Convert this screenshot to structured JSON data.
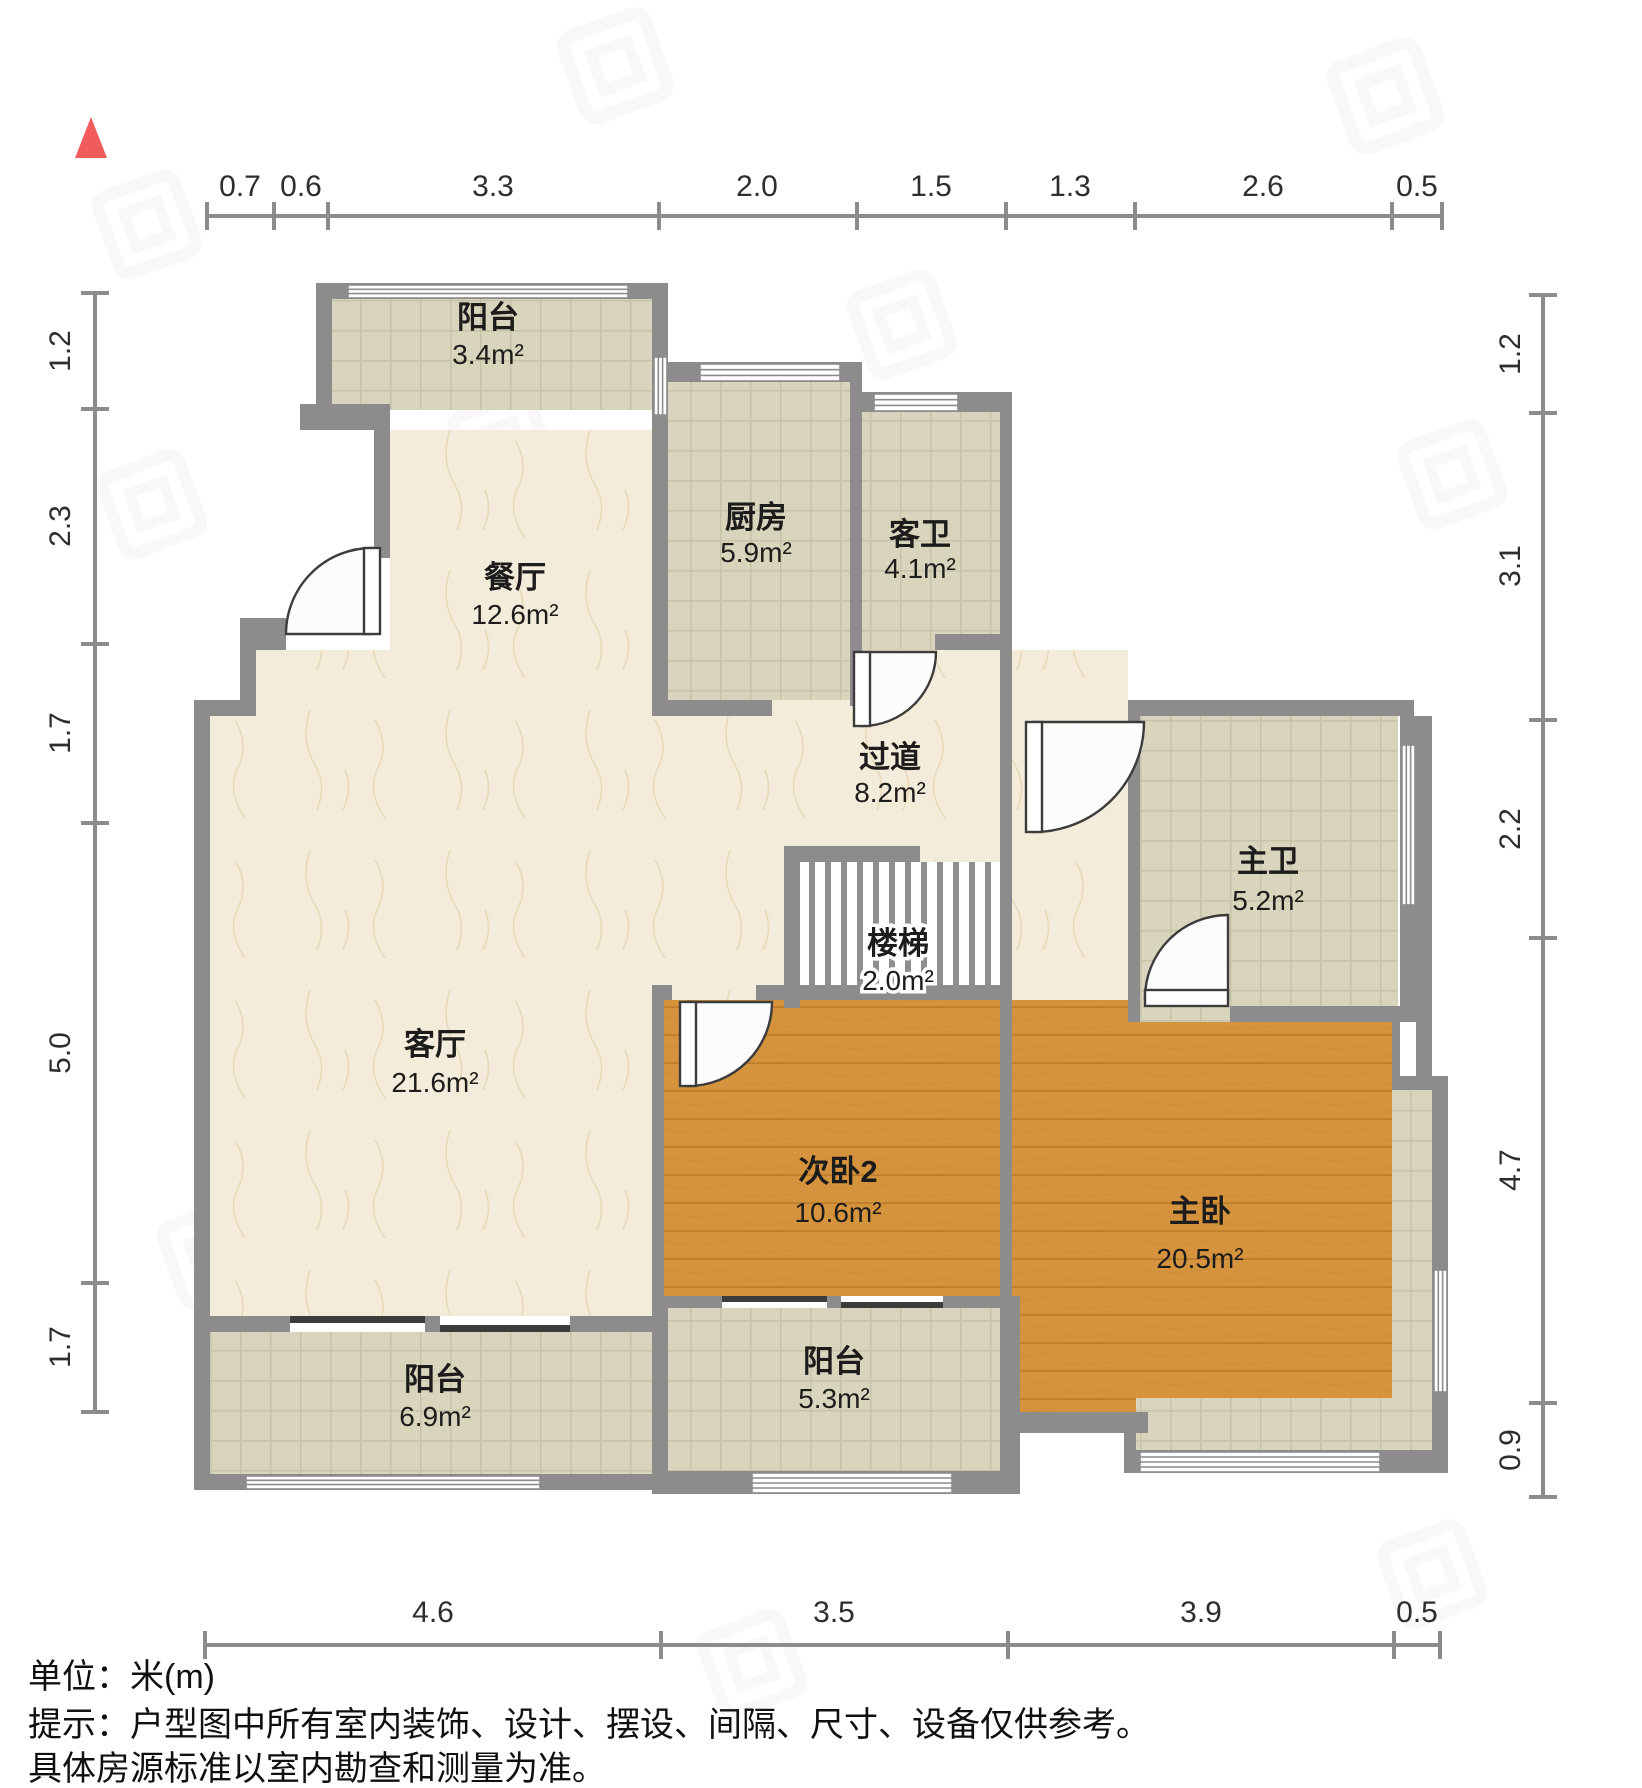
{
  "rooms": {
    "balcony_top": {
      "name": "阳台",
      "area": "3.4m²"
    },
    "dining": {
      "name": "餐厅",
      "area": "12.6m²"
    },
    "kitchen": {
      "name": "厨房",
      "area": "5.9m²"
    },
    "guest_bath": {
      "name": "客卫",
      "area": "4.1m²"
    },
    "hallway": {
      "name": "过道",
      "area": "8.2m²"
    },
    "stairs": {
      "name": "楼梯",
      "area": "2.0m²"
    },
    "master_bath": {
      "name": "主卫",
      "area": "5.2m²"
    },
    "living": {
      "name": "客厅",
      "area": "21.6m²"
    },
    "bed2": {
      "name": "次卧2",
      "area": "10.6m²"
    },
    "master_bed": {
      "name": "主卧",
      "area": "20.5m²"
    },
    "balcony_left": {
      "name": "阳台",
      "area": "6.9m²"
    },
    "balcony_mid": {
      "name": "阳台",
      "area": "5.3m²"
    }
  },
  "dims": {
    "top": [
      "0.7",
      "0.6",
      "3.3",
      "2.0",
      "1.5",
      "1.3",
      "2.6",
      "0.5"
    ],
    "left": [
      "1.2",
      "2.3",
      "1.7",
      "5.0",
      "1.7"
    ],
    "right": [
      "1.2",
      "3.1",
      "2.2",
      "4.7",
      "0.9"
    ],
    "bottom": [
      "4.6",
      "3.5",
      "3.9",
      "0.5"
    ]
  },
  "footer": {
    "unit": "单位：米(m)",
    "tip1": "提示：户型图中所有室内装饰、设计、摆设、间隔、尺寸、设备仅供参考。",
    "tip2": "具体房源标准以室内勘查和测量为准。"
  },
  "colors": {
    "wall": "#8c8c8c",
    "sill": "#3c3c3c",
    "tile_floor": "#d9d5bd",
    "marble_floor": "#f4ecda",
    "wood_floor": "#d5933e",
    "north_arrow": "#f15b5b",
    "dimension_line": "#8c8c8c",
    "text": "#1c1c1c"
  }
}
